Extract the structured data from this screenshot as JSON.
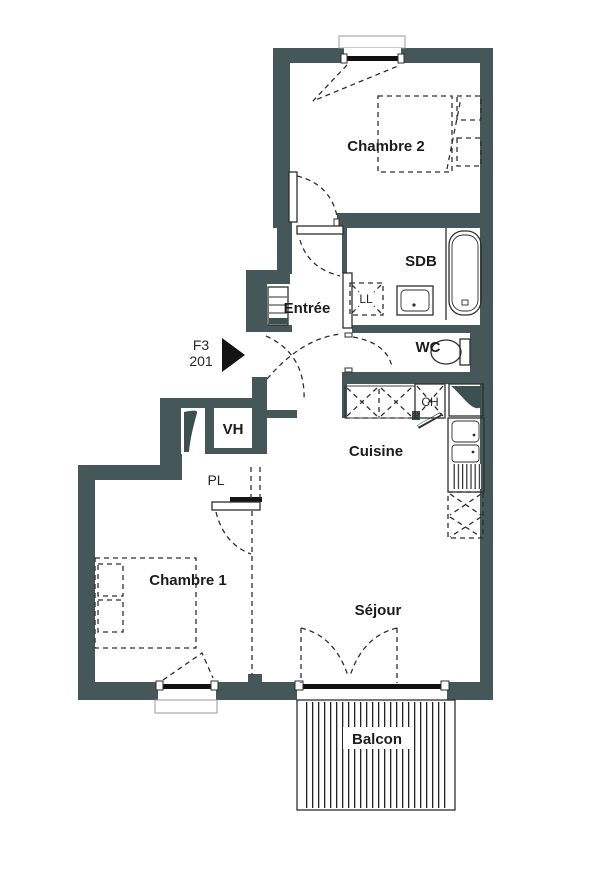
{
  "plan": {
    "unit_type": "F3",
    "unit_number": "201",
    "rooms": {
      "chambre2": "Chambre 2",
      "sdb": "SDB",
      "entree": "Entrée",
      "wc": "WC",
      "vh": "VH",
      "pl": "PL",
      "cuisine": "Cuisine",
      "chambre1": "Chambre 1",
      "sejour": "Séjour",
      "balcon": "Balcon"
    },
    "appliances": {
      "lave_linge": "LL",
      "chauffe_eau": "CH"
    },
    "colors": {
      "wall": "#455759",
      "line": "#2e2e2e",
      "background": "#ffffff"
    }
  }
}
